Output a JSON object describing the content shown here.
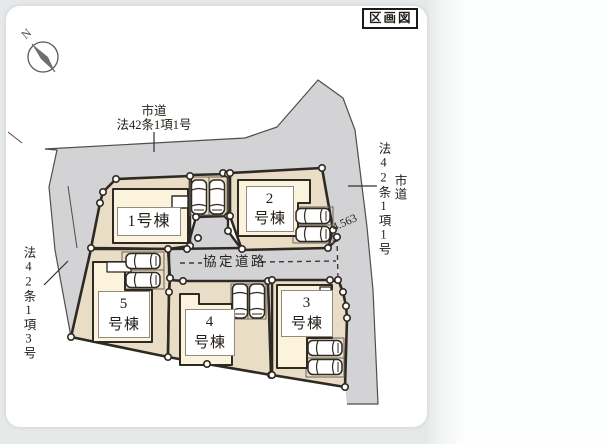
{
  "title_badge": "区画図",
  "compass": {
    "north": "N"
  },
  "roads": {
    "top": {
      "type": "市道",
      "law": "法42条1項1号"
    },
    "right": {
      "law": "法42条1項1号",
      "type": "市道"
    },
    "left": {
      "law": "法42条1項3号"
    },
    "agreement": {
      "label": "協定道路"
    },
    "width_dimension": "4.563"
  },
  "lots": [
    {
      "id": 1,
      "name": "1号棟",
      "display": "1号棟"
    },
    {
      "id": 2,
      "name": "2号棟",
      "display": "2\n号棟"
    },
    {
      "id": 3,
      "name": "3号棟",
      "display": "3\n号棟"
    },
    {
      "id": 4,
      "name": "4号棟",
      "display": "4\n号棟"
    },
    {
      "id": 5,
      "name": "5号棟",
      "display": "5\n号棟"
    }
  ],
  "colors": {
    "road_fill": "#d3d3d5",
    "parcel_fill": "#e9ddc5",
    "building_fill": "#fbf3dc",
    "outline": "#2e2922",
    "frame": "#e6e9ea"
  }
}
